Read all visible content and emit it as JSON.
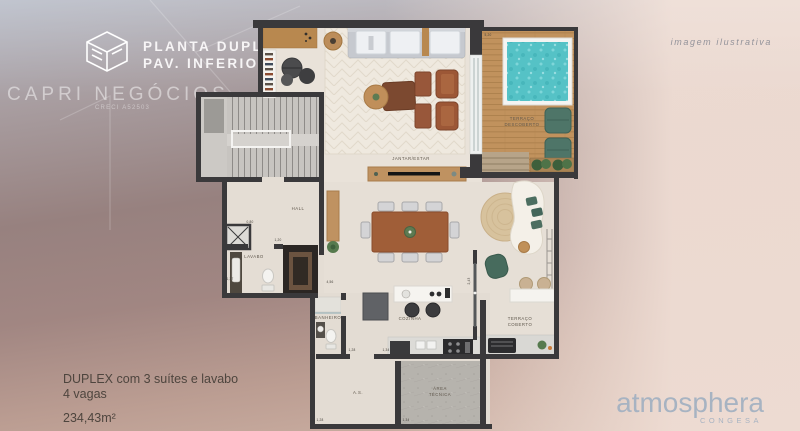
{
  "header": {
    "title_line1": "PLANTA DUPLEX",
    "title_line2": "PAV. INFERIOR",
    "brand": "CAPRI NEGÓCIOS",
    "brand_sub": "CRECI A52503"
  },
  "watermark_note": "imagem ilustrativa",
  "summary": {
    "line1": "DUPLEX com 3 suítes e lavabo",
    "line2": "4 vagas",
    "area": "234,43m²"
  },
  "developer": {
    "name": "atmosphera",
    "brand": "CONGESA"
  },
  "floorplan": {
    "rooms": {
      "hall": "HALL",
      "lavabo": "LAVABO",
      "jantar_estar": "JANTAR/ESTAR",
      "cozinha": "COZINHA",
      "banheiro": "BANHEIRO",
      "area_servico": "A.S.",
      "area_tecnica": [
        "ÁREA",
        "TÉCNICA"
      ],
      "terraco_coberto": [
        "TERRAÇO",
        "COBERTO"
      ],
      "terraco_descoberto": [
        "TERRAÇO",
        "DESCOBERTO"
      ]
    },
    "dimensions": {
      "hall_door": "0,80",
      "hall_passage": "1,20",
      "lavabo_width": "1,37",
      "corridor": "4,56",
      "banheiro_door": "1,28",
      "as_width": "1,28",
      "at_width": "1,34",
      "cozinha_counter": "1,34",
      "terraco_door": "2,43",
      "deck_width": "5,20"
    },
    "colors": {
      "wall": "#3a393b",
      "floor": "#e7e0d7",
      "deck_wood": "#c1925d",
      "pool_water": "#55c2c6",
      "upholstery_green": "#476b5d",
      "wood_furniture": "#bf9261",
      "background_blue_gray": "#b5bac6",
      "background_mauve": "#97817f",
      "background_cream": "#eedbd2",
      "developer_blue": "#a7b3c2"
    }
  }
}
